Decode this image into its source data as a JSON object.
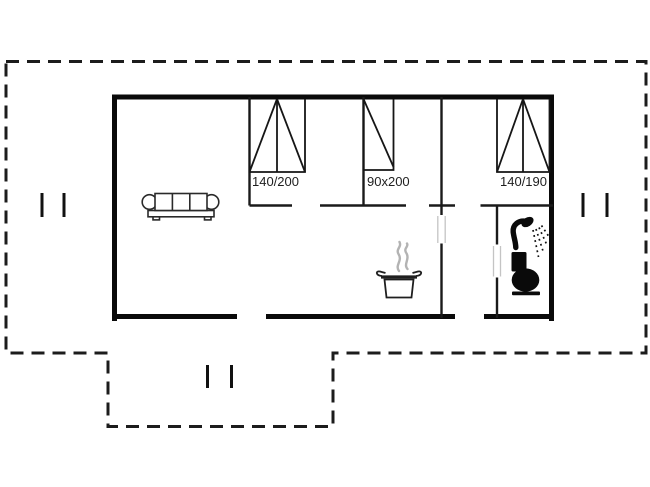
{
  "plan": {
    "title": "holiday-house-floor-plan",
    "beds": [
      {
        "id": "double-bed-left",
        "label": "140/200"
      },
      {
        "id": "single-bed-mid",
        "label": "90x200"
      },
      {
        "id": "double-bed-right",
        "label": "140/190"
      }
    ],
    "icons": [
      "sofa-icon",
      "cooking-pot-icon",
      "steam-icon",
      "shower-icon",
      "toilet-icon",
      "window-mark"
    ],
    "colors": {
      "wall": "#0a0a0a",
      "interior_wall": "#1a1a1a",
      "terrace_outline": "#1c1c1c",
      "furniture_line": "#2a2a2a",
      "steam": "#b3b3b3",
      "door_jamb": "#c4c4c4",
      "label_text": "#1f1f1f",
      "background": "#ffffff"
    }
  }
}
